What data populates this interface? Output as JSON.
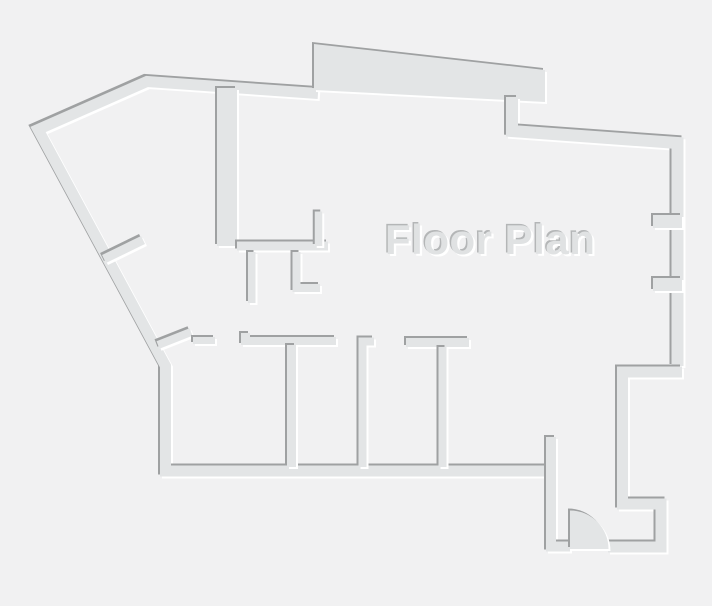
{
  "title": {
    "label": "Floor Plan"
  },
  "colors": {
    "background": "#f1f1f2",
    "wall": "#e3e5e6",
    "shadow_dark": "#9fa1a2",
    "highlight": "#ffffff",
    "title_text": "#e0e2e3",
    "title_shadow_dark": "#b4b6b7"
  },
  "canvas": {
    "width": 712,
    "height": 606
  },
  "plan": {
    "walls": [
      {
        "name": "exterior-outline-wall",
        "d": "M318,93.5 L147,81.5 L38,129.5 L165.5,366 L165.5,471 L552,471",
        "w": 11
      },
      {
        "name": "balcony-slab",
        "points": "314,44 545,70 545,102 314,90",
        "fill": true
      },
      {
        "name": "exterior-top-right-wall",
        "d": "M512,97 L512,131 L677.5,143 L677.5,366",
        "w": 12
      },
      {
        "name": "window-jamb-upper",
        "d": "M653,221.5 L682,221.5",
        "w": 13
      },
      {
        "name": "window-jamb-lower",
        "d": "M653,284.5 L682,284.5",
        "w": 13
      },
      {
        "name": "exterior-bottom-right-wall",
        "d": "M682,372 L622.5,372 L622.5,504 L661,504 L661,547 L608,547",
        "w": 11
      },
      {
        "name": "entry-left-wall",
        "d": "M551,437 L551,546.5 L570,546.5",
        "w": 10
      },
      {
        "name": "entry-door-swing",
        "d": "M570,510.5 A38.5,38.5 0 0 1 608.5,549 L570,549 Z",
        "fill": true
      },
      {
        "name": "core-thick-wall",
        "d": "M227,88 L227,246",
        "w": 20
      },
      {
        "name": "hall-wall",
        "d": "M237,246 L328,246",
        "w": 9
      },
      {
        "name": "hall-jamb-stub",
        "d": "M318.5,211.5 L318.5,246",
        "w": 7.5
      },
      {
        "name": "closet-wall-a",
        "d": "M251.75,252 L251.75,303",
        "w": 7.5
      },
      {
        "name": "closet-wall-b",
        "d": "M296.5,252 L296.5,288 L320,288",
        "w": 8
      },
      {
        "name": "diagonal-door-stub",
        "d": "M158,345 L191,332",
        "w": 8
      },
      {
        "name": "doorway-stub",
        "d": "M193,340.5 L215,340.5",
        "w": 7
      },
      {
        "name": "lower-corridor-wall",
        "d": "M241,337 L250,337 M241,341 L336,341",
        "w": 8
      },
      {
        "name": "room-divider-1",
        "d": "M291.5,345 L291.5,467",
        "w": 9
      },
      {
        "name": "room-divider-2",
        "d": "M374,341.5 L362.5,341.5 L362.5,467",
        "w": 8
      },
      {
        "name": "room-divider-3-header",
        "d": "M406,342.5 L469,342.5",
        "w": 9
      },
      {
        "name": "room-divider-3",
        "d": "M442.5,347 L442.5,467",
        "w": 8
      },
      {
        "name": "diagonal-wall-jamb",
        "d": "M104,259 L143,240",
        "w": 9
      }
    ]
  }
}
